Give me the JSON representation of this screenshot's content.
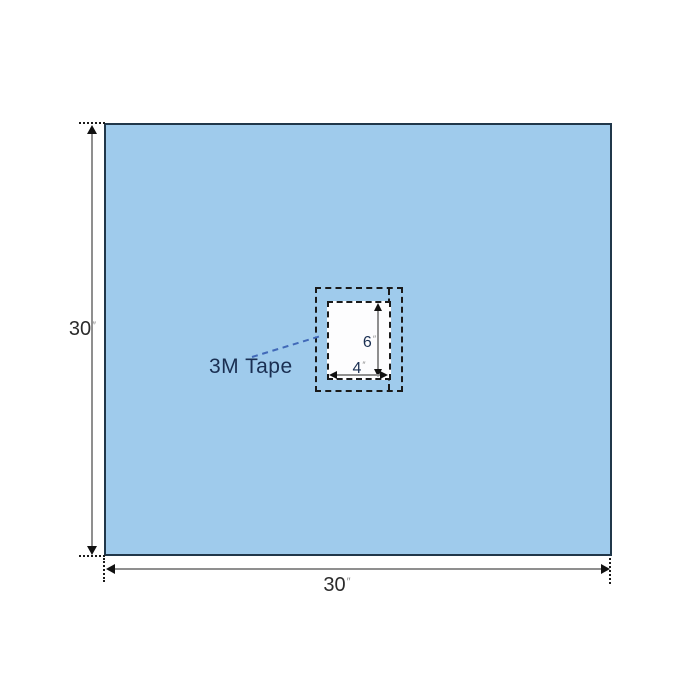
{
  "diagram": {
    "drape": {
      "height_dim": {
        "value": "30",
        "unit": "″"
      },
      "width_dim": {
        "value": "30",
        "unit": "″"
      },
      "fill_color": "#9FCBEC",
      "border_color": "#20374A"
    },
    "fenestration": {
      "height_dim": {
        "value": "6",
        "unit": "″"
      },
      "width_dim": {
        "value": "4",
        "unit": "″"
      },
      "fill_color": "#FDFDFE"
    },
    "tape": {
      "label": "3M Tape",
      "leader_color": "#4169B8"
    },
    "colors": {
      "dimension_line": "#8F8F8F",
      "arrowhead": "#111111",
      "dash_outline": "#1A1A1A",
      "dim_text": "#2B2B2B",
      "navy_text": "#1A2F52",
      "unit_mark": "#8A8A8A",
      "background": "#FFFFFF"
    }
  }
}
